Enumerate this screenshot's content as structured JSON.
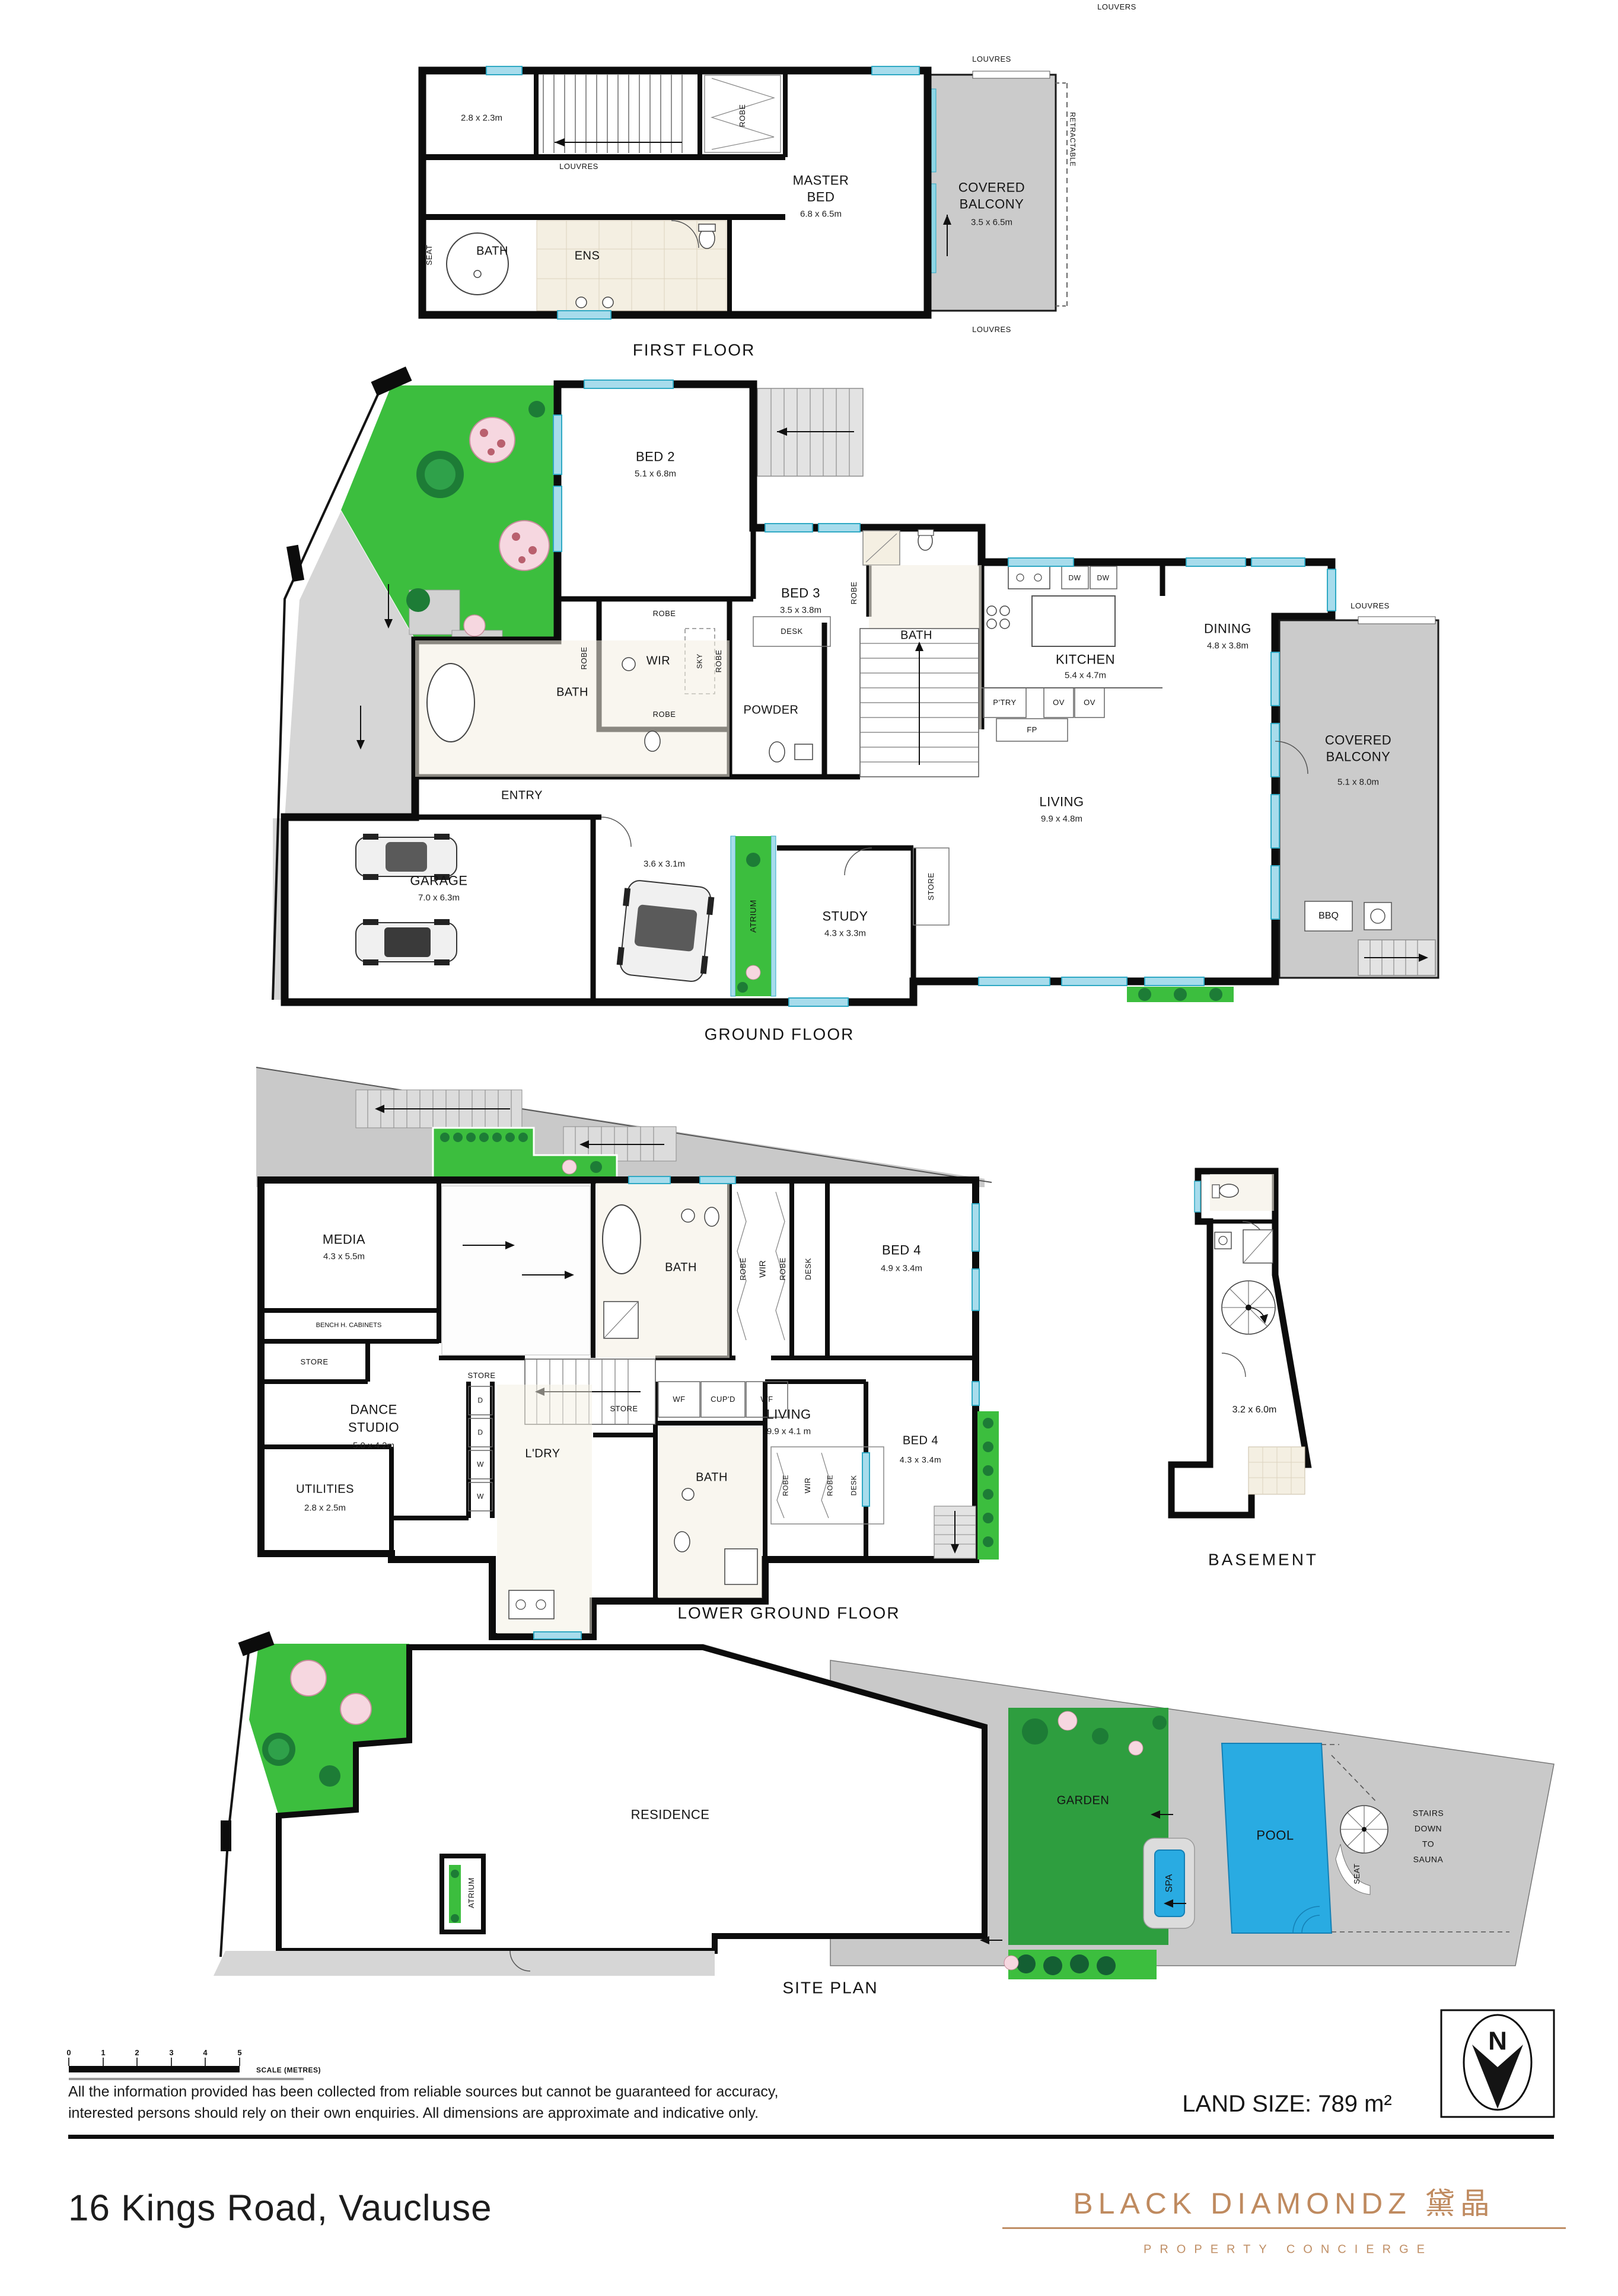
{
  "page": {
    "top_louvers": "LOUVERS",
    "captions": {
      "first": "FIRST FLOOR",
      "ground": "GROUND FLOOR",
      "lower": "LOWER GROUND FLOOR",
      "basement": "BASEMENT",
      "site": "SITE PLAN"
    },
    "scale_bar": {
      "ticks": [
        "0",
        "1",
        "2",
        "3",
        "4",
        "5"
      ],
      "label": "SCALE (METRES)"
    },
    "disclaimer_line1": "All the information provided has been collected from reliable sources but cannot be guaranteed for accuracy,",
    "disclaimer_line2": "interested persons should rely on their own enquiries. All dimensions are approximate and indicative only.",
    "land_size": "LAND SIZE: 789 m²",
    "address": "16 Kings Road, Vaucluse",
    "compass_n": "N",
    "logo": {
      "brand": "BLACK DIAMONDZ 黛晶",
      "tagline": "PROPERTY CONCIERGE"
    }
  },
  "first_floor": {
    "room_dim": "2.8 x 2.3m",
    "robe": "ROBE",
    "louvres_top": "LOUVRES",
    "louvres_mid": "LOUVRES",
    "louvres_bottom": "LOUVRES",
    "retractable": "RETRACTABLE",
    "master_bed": "MASTER BED",
    "master_bed_dim": "6.8 x 6.5m",
    "covered_balcony": "COVERED BALCONY",
    "covered_balcony_dim": "3.5 x 6.5m",
    "bath": "BATH",
    "seat": "SEAT",
    "ens": "ENS"
  },
  "ground_floor": {
    "bed2": "BED 2",
    "bed2_dim": "5.1 x 6.8m",
    "bed3": "BED 3",
    "bed3_dim": "3.5 x 3.8m",
    "robe_bed3": "ROBE",
    "bath_ens": "BATH",
    "robe_left": "ROBE",
    "robe_top": "ROBE",
    "robe_right": "ROBE",
    "robe_bottom": "ROBE",
    "wir": "WIR",
    "sky": "SKY",
    "desk": "DESK",
    "bath_main": "BATH",
    "powder": "POWDER",
    "entry": "ENTRY",
    "garage": "GARAGE",
    "garage_dim": "7.0 x 6.3m",
    "carport_dim": "3.6 x 3.1m",
    "atrium": "ATRIUM",
    "study": "STUDY",
    "study_dim": "4.3 x 3.3m",
    "store": "STORE",
    "kitchen": "KITCHEN",
    "kitchen_dim": "5.4 x 4.7m",
    "ptry": "P'TRY",
    "ov1": "OV",
    "ov2": "OV",
    "dw1": "DW",
    "dw2": "DW",
    "fp": "FP",
    "dining": "DINING",
    "dining_dim": "4.8 x 3.8m",
    "living": "LIVING",
    "living_dim": "9.9 x 4.8m",
    "louvres": "LOUVRES",
    "covered_balcony": "COVERED BALCONY",
    "covered_balcony_dim": "5.1 x 8.0m",
    "bbq": "BBQ"
  },
  "lower_ground": {
    "media": "MEDIA",
    "media_dim": "4.3 x 5.5m",
    "bench": "BENCH H. CABINETS",
    "store_left": "STORE",
    "store_mid": "STORE",
    "store_bottom": "STORE",
    "bath_upper": "BATH",
    "robe_a": "ROBE",
    "wir_upper": "WIR",
    "robe_b": "ROBE",
    "desk_upper": "DESK",
    "bed4_upper": "BED 4",
    "bed4_upper_dim": "4.9 x 3.4m",
    "living": "LIVING",
    "living_dim": "9.9 x 4.1 m",
    "dance_l1": "DANCE",
    "dance_l2": "STUDIO",
    "dance_dim": "5.0 x 4.2m",
    "d1": "D",
    "d2": "D",
    "w1": "W",
    "w2": "W",
    "ldry": "L'DRY",
    "wf1": "WF",
    "cupd": "CUP'D",
    "wf2": "WF",
    "bath_lower": "BATH",
    "robe_c": "ROBE",
    "wir_lower": "WIR",
    "robe_d": "ROBE",
    "desk_lower": "DESK",
    "bed4_lower": "BED 4",
    "bed4_lower_dim": "4.3 x 3.4m",
    "utilities": "UTILITIES",
    "utilities_dim": "2.8 x 2.5m"
  },
  "basement": {
    "room_dim": "3.2 x 6.0m"
  },
  "site_plan": {
    "residence": "RESIDENCE",
    "atrium": "ATRIUM",
    "garden": "GARDEN",
    "spa": "SPA",
    "pool": "POOL",
    "stairs_l1": "STAIRS",
    "stairs_l2": "DOWN",
    "stairs_l3": "TO",
    "stairs_l4": "SAUNA",
    "seat": "SEAT"
  },
  "colors": {
    "wall": "#0c0c0c",
    "window": "#a7dcec",
    "deck_gray": "#c9c9c9",
    "garden_green": "#3cbe3e",
    "pool_blue": "#29abe2",
    "tile": "#f4efe2",
    "brand_copper": "#bf8a5f"
  }
}
